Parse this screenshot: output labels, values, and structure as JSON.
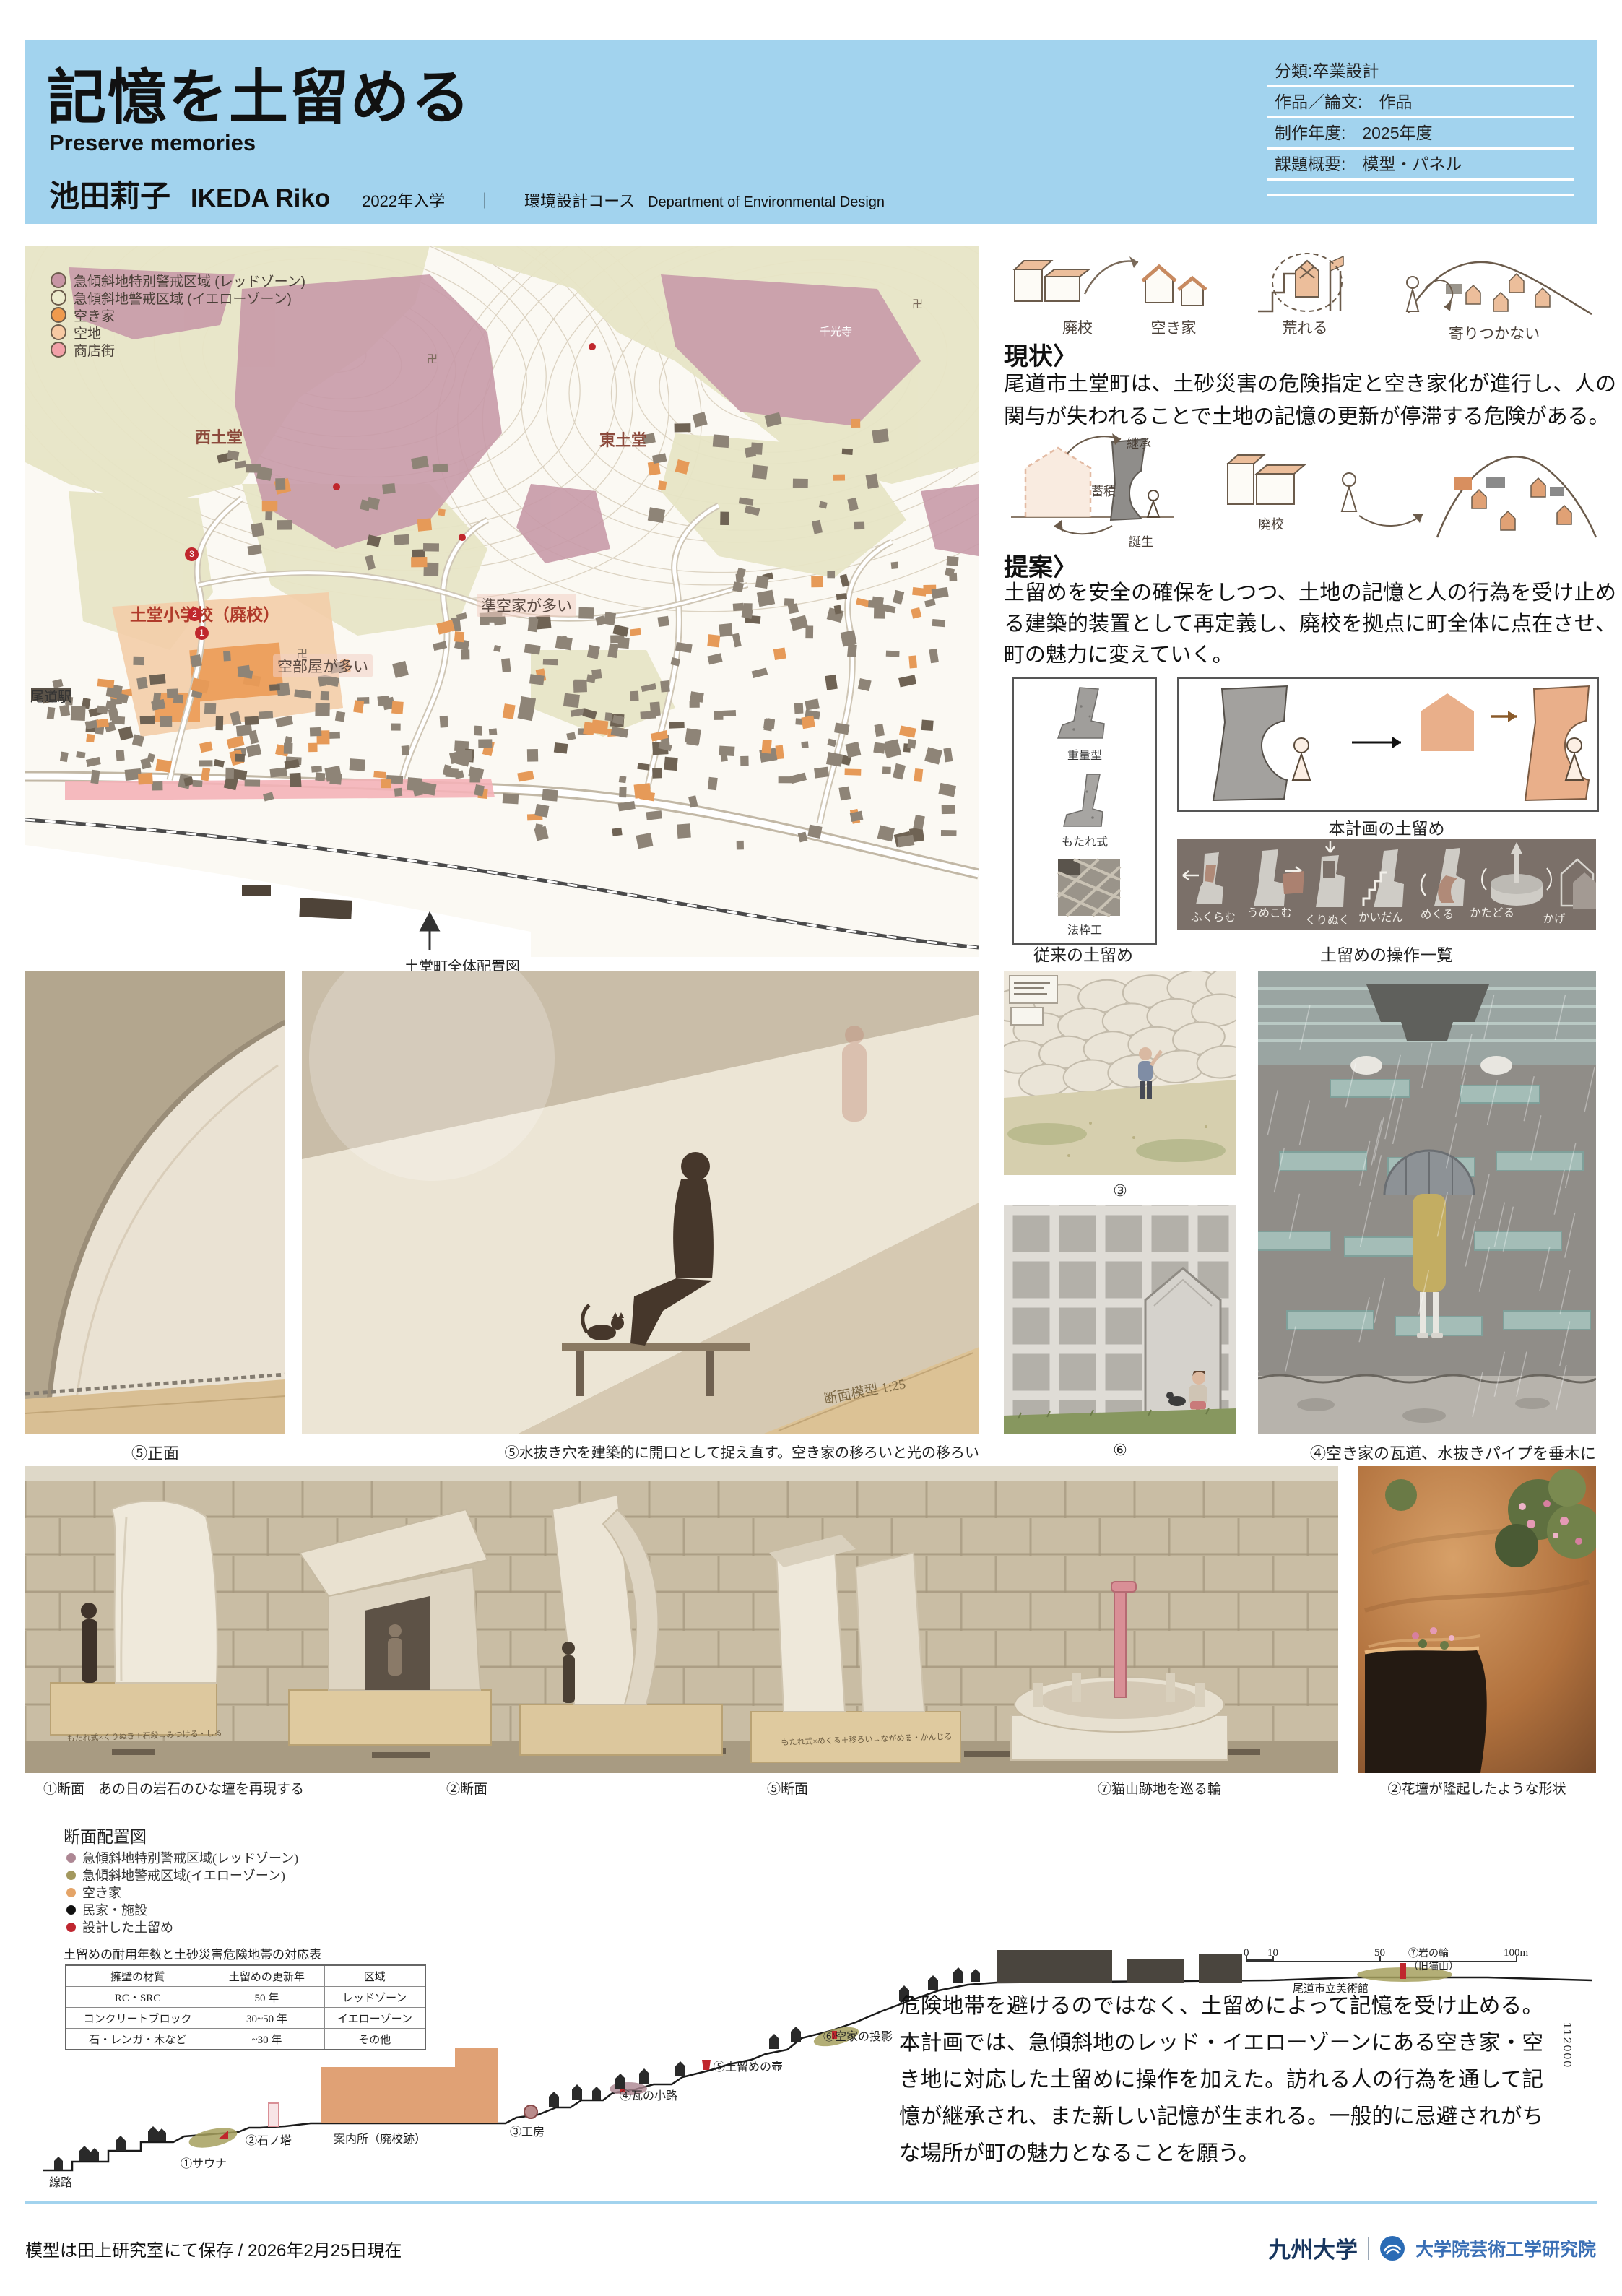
{
  "header": {
    "title": "記憶を土留める",
    "subtitle": "Preserve memories",
    "author_jp": "池田莉子",
    "author_en": "IKEDA Riko",
    "admission": "2022年入学",
    "separator": "｜",
    "course_jp": "環境設計コース",
    "course_en": "Department of Environmental Design",
    "meta": [
      {
        "text": "分類:卒業設計"
      },
      {
        "text": "作品／論文:　作品"
      },
      {
        "text": "制作年度:　2025年度"
      },
      {
        "text": "課題概要:　模型・パネル"
      }
    ]
  },
  "map": {
    "legend": [
      {
        "label": "急傾斜地特別警戒区域 (レッドゾーン)",
        "color": "#c795a4"
      },
      {
        "label": "急傾斜地警戒区域 (イエローゾーン)",
        "color": "#ecebcd"
      },
      {
        "label": "空き家",
        "color": "#ef9a4d"
      },
      {
        "label": "空地",
        "color": "#f7c9a3"
      },
      {
        "label": "商店街",
        "color": "#f2a0a8"
      }
    ],
    "labels": {
      "west": "西土堂",
      "east": "東土堂",
      "temple": "千光寺",
      "school": "土堂小学校（廃校）",
      "empty_rooms": "空部屋が多い",
      "semi_vacant": "準空家が多い",
      "station": "尾道駅"
    },
    "markers": [
      "1",
      "2",
      "3"
    ],
    "caption": "土堂町全体配置図"
  },
  "current": {
    "heading": "現状〉",
    "icons": [
      "廃校",
      "空き家",
      "荒れる",
      "寄りつかない"
    ],
    "body": "尾道市土堂町は、土砂災害の危険指定と空き家化が進行し、人の関与が失われることで土地の記憶の更新が停滞する危険がある。"
  },
  "proposal": {
    "heading": "提案〉",
    "cycle": [
      "継承",
      "蓄積",
      "誕生"
    ],
    "school_label": "廃校",
    "body": "土留めを安全の確保をしつつ、土地の記憶と人の行為を受け止める建築的装置として再定義し、廃校を拠点に町全体に点在させ、町の魅力に変えていく。"
  },
  "walls": {
    "types": [
      "重量型",
      "もたれ式",
      "法枠工"
    ],
    "left_caption": "従来の土留め",
    "plan_caption": "本計画の土留め",
    "ops_caption": "土留めの操作一覧",
    "operations": [
      "ふくらむ",
      "うめこむ",
      "くりぬく",
      "かいだん",
      "めくる",
      "かたどる",
      "かげ"
    ]
  },
  "photos": {
    "front": "⑤正面",
    "drain": "⑤水抜き穴を建築的に開口として捉え直す。空き家の移ろいと光の移ろい",
    "c3": "③",
    "c6": "⑥",
    "tile": "④空き家の瓦道、水抜きパイプを垂木に",
    "model_label": "断面模型 1:25",
    "plaque1": "もたれ式×くりぬき＋石段→みつける・しる",
    "plaque2": "もたれ式×めくる＋移ろい→ながめる・かんじる",
    "bottom": [
      {
        "caption": "①断面　あの日の岩石のひな壇を再現する"
      },
      {
        "caption": "②断面"
      },
      {
        "caption": "⑤断面"
      },
      {
        "caption": "⑦猫山跡地を巡る輪"
      }
    ],
    "rock_caption": "②花壇が隆起したような形状"
  },
  "section": {
    "title": "断面配置図",
    "legend": [
      {
        "label": "急傾斜地特別警戒区域(レッドゾーン)",
        "color": "#ad8794"
      },
      {
        "label": "急傾斜地警戒区域(イエローゾーン)",
        "color": "#a3985e"
      },
      {
        "label": "空き家",
        "color": "#e4a468"
      },
      {
        "label": "民家・施設",
        "color": "#111111"
      },
      {
        "label": "設計した土留め",
        "color": "#bf2630"
      }
    ],
    "table": {
      "title": "土留めの耐用年数と土砂災害危険地帯の対応表",
      "headers": [
        "擁壁の材質",
        "土留めの更新年",
        "区域"
      ],
      "rows": [
        [
          "RC・SRC",
          "50 年",
          "レッドゾーン"
        ],
        [
          "コンクリートブロック",
          "30~50 年",
          "イエローゾーン"
        ],
        [
          "石・レンガ・木など",
          "~30 年",
          "その他"
        ]
      ]
    },
    "points": {
      "rail": "線路",
      "p1": "①サウナ",
      "p2": "②石ノ塔",
      "info": "案内所（廃校跡）",
      "p3": "③工房",
      "p4": "④瓦の小路",
      "p5": "⑤土留めの壺",
      "p6": "⑥空家の投影",
      "p7a": "⑦岩の輪",
      "p7b": "（旧猫山）",
      "museum": "尾道市立美術館"
    },
    "scale": {
      "t0": "0",
      "t10": "10",
      "t50": "50",
      "t100": "100m"
    }
  },
  "conclusion": {
    "body": "危険地帯を避けるのではなく、土留めによって記憶を受け止める。本計画では、急傾斜地のレッド・イエローゾーンにある空き家・空き地に対応した土留めに操作を加えた。訪れる人の行為を通して記憶が継承され、また新しい記憶が生まれる。一般的に忌避されがちな場所が町の魅力となることを願う。",
    "side_note": "112000"
  },
  "footer": {
    "note": "模型は田上研究室にて保存 / 2026年2月25日現在",
    "university": "九州大学",
    "school": "大学院芸術工学研究院"
  }
}
